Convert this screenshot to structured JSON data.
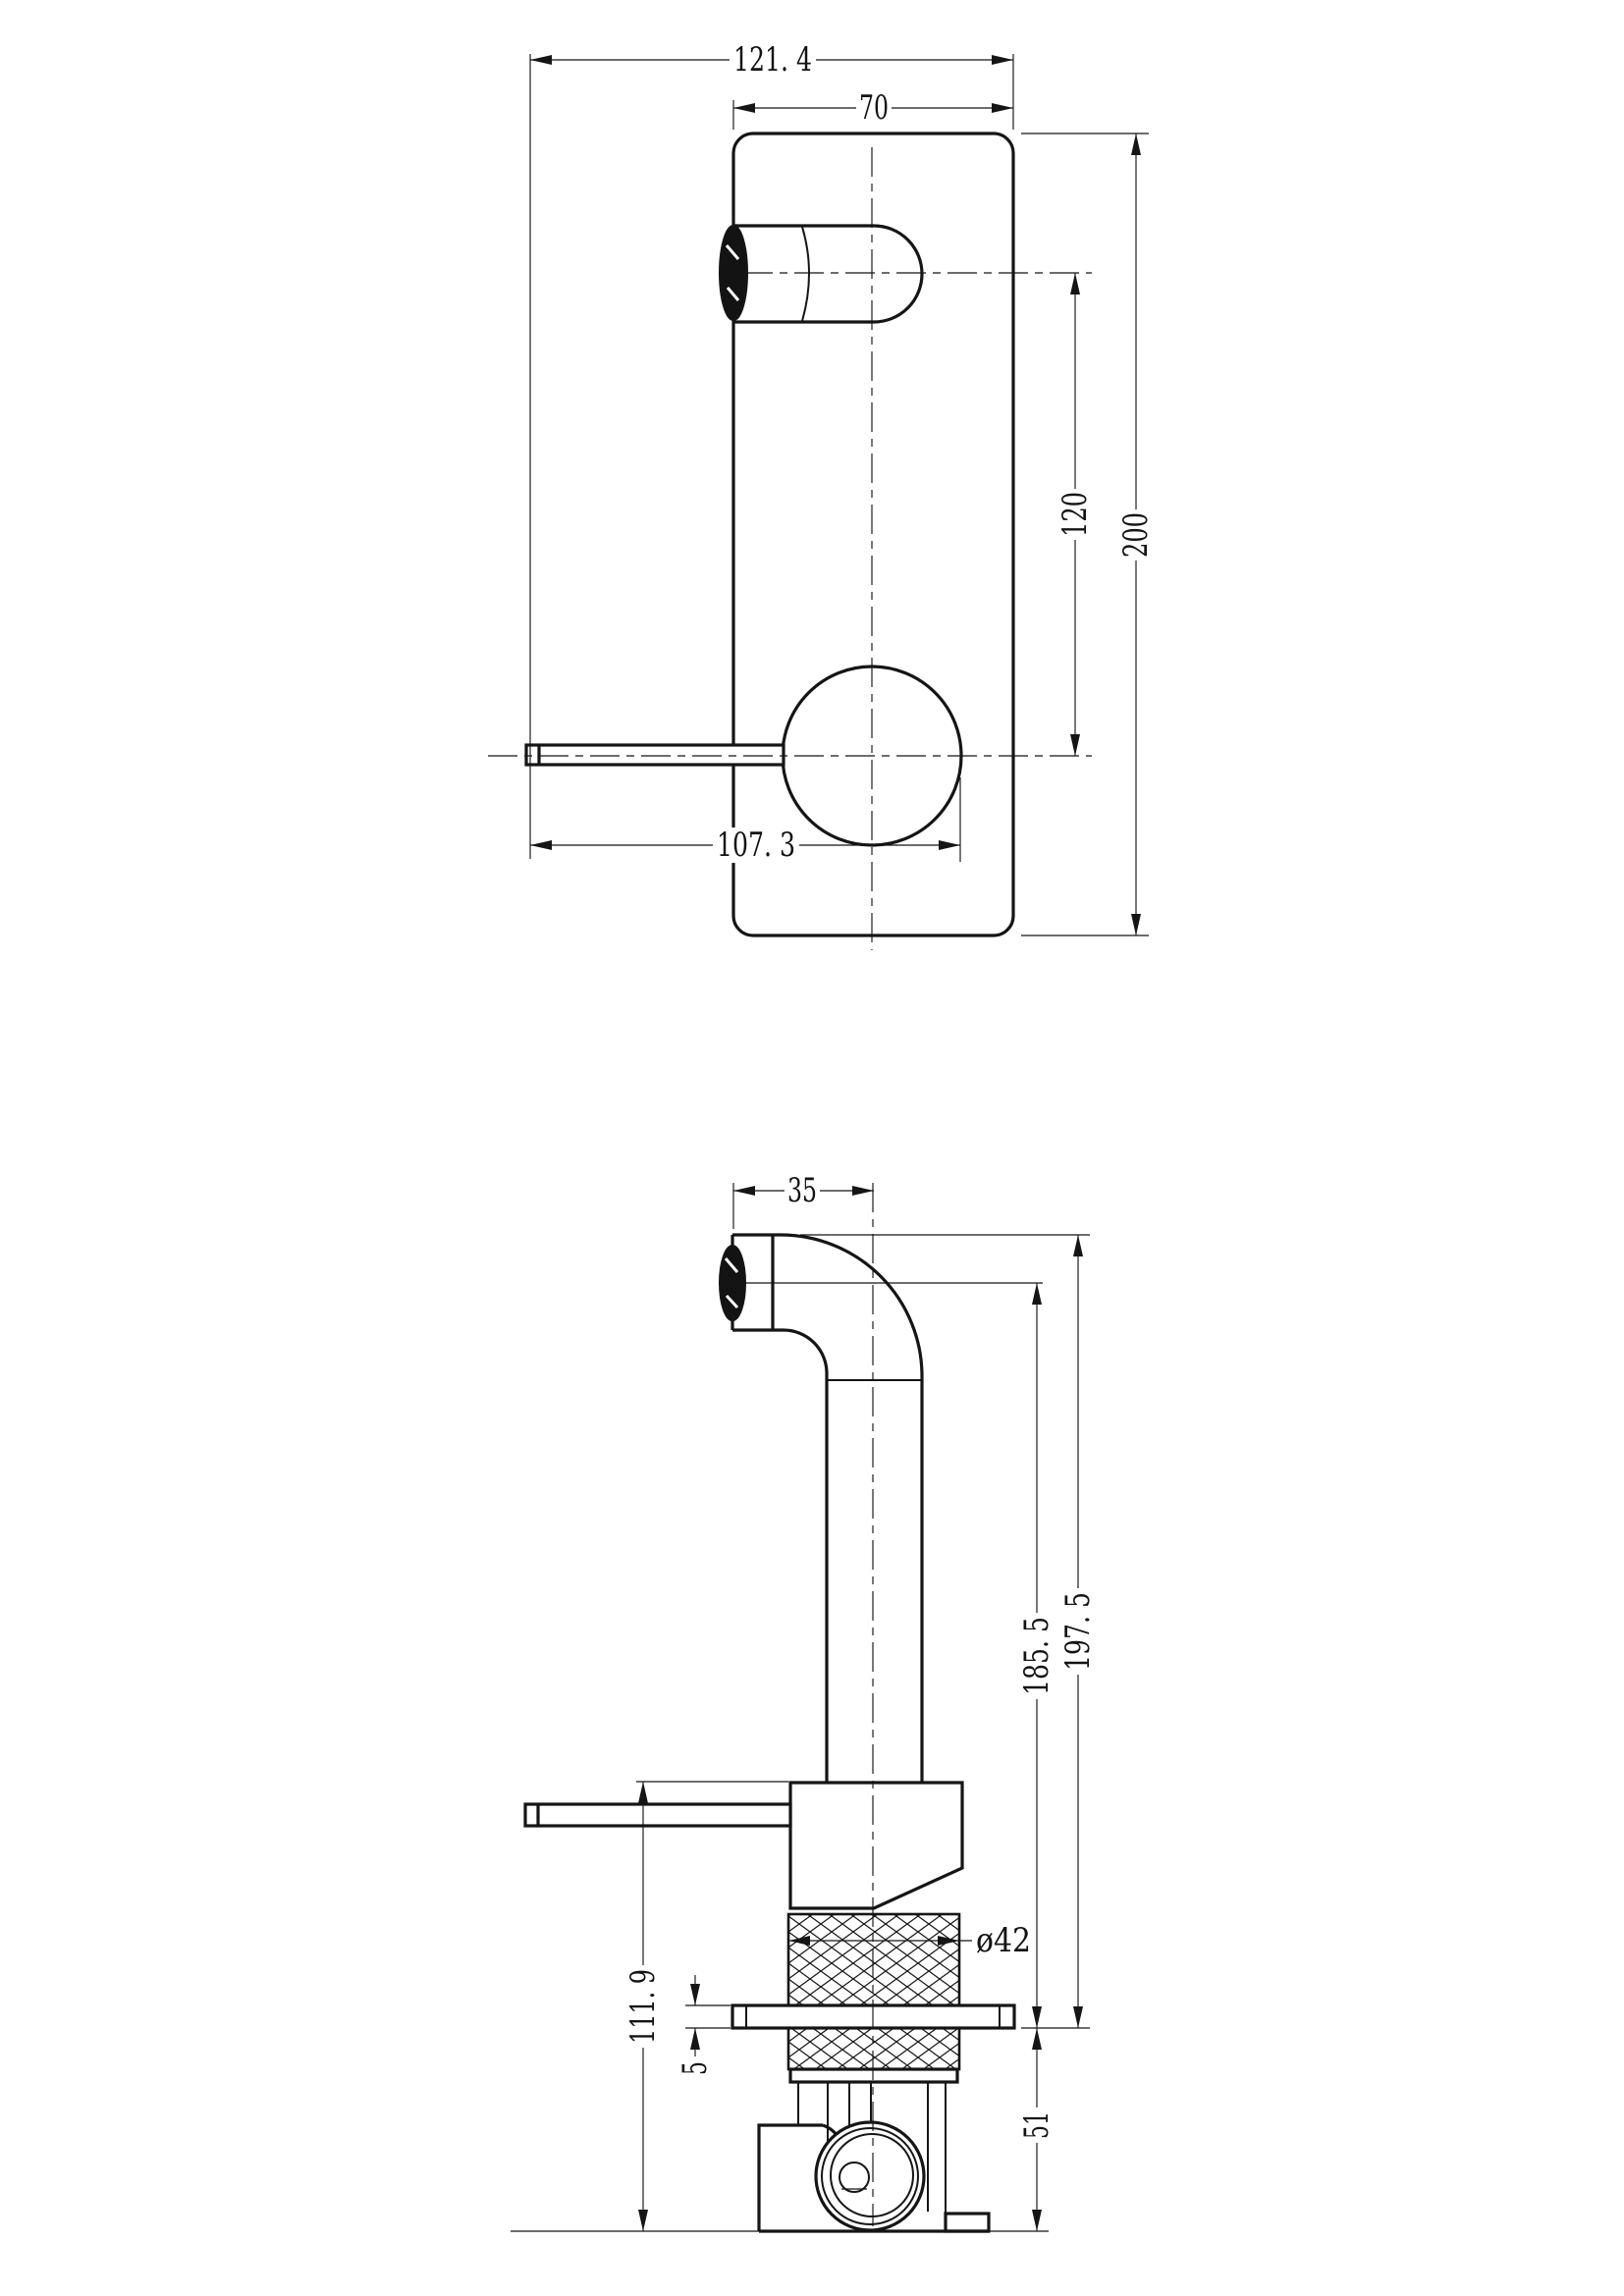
{
  "page": {
    "paper_color": "#ffffff",
    "ink_color": "#151515"
  },
  "front_view": {
    "dimensions": {
      "overall_width": "121. 4",
      "plate_width": "70",
      "spout_to_handle_centers": "120",
      "plate_height": "200",
      "handle_reach": "107. 3"
    }
  },
  "side_view": {
    "dimensions": {
      "spout_projection": "35",
      "height_to_spout_top": "197. 5",
      "height_to_spout_center": "185. 5",
      "valve_body_height": "111. 9",
      "plate_thickness": "5",
      "rear_depth": "51",
      "trim_sleeve_diameter": "ø42"
    }
  }
}
